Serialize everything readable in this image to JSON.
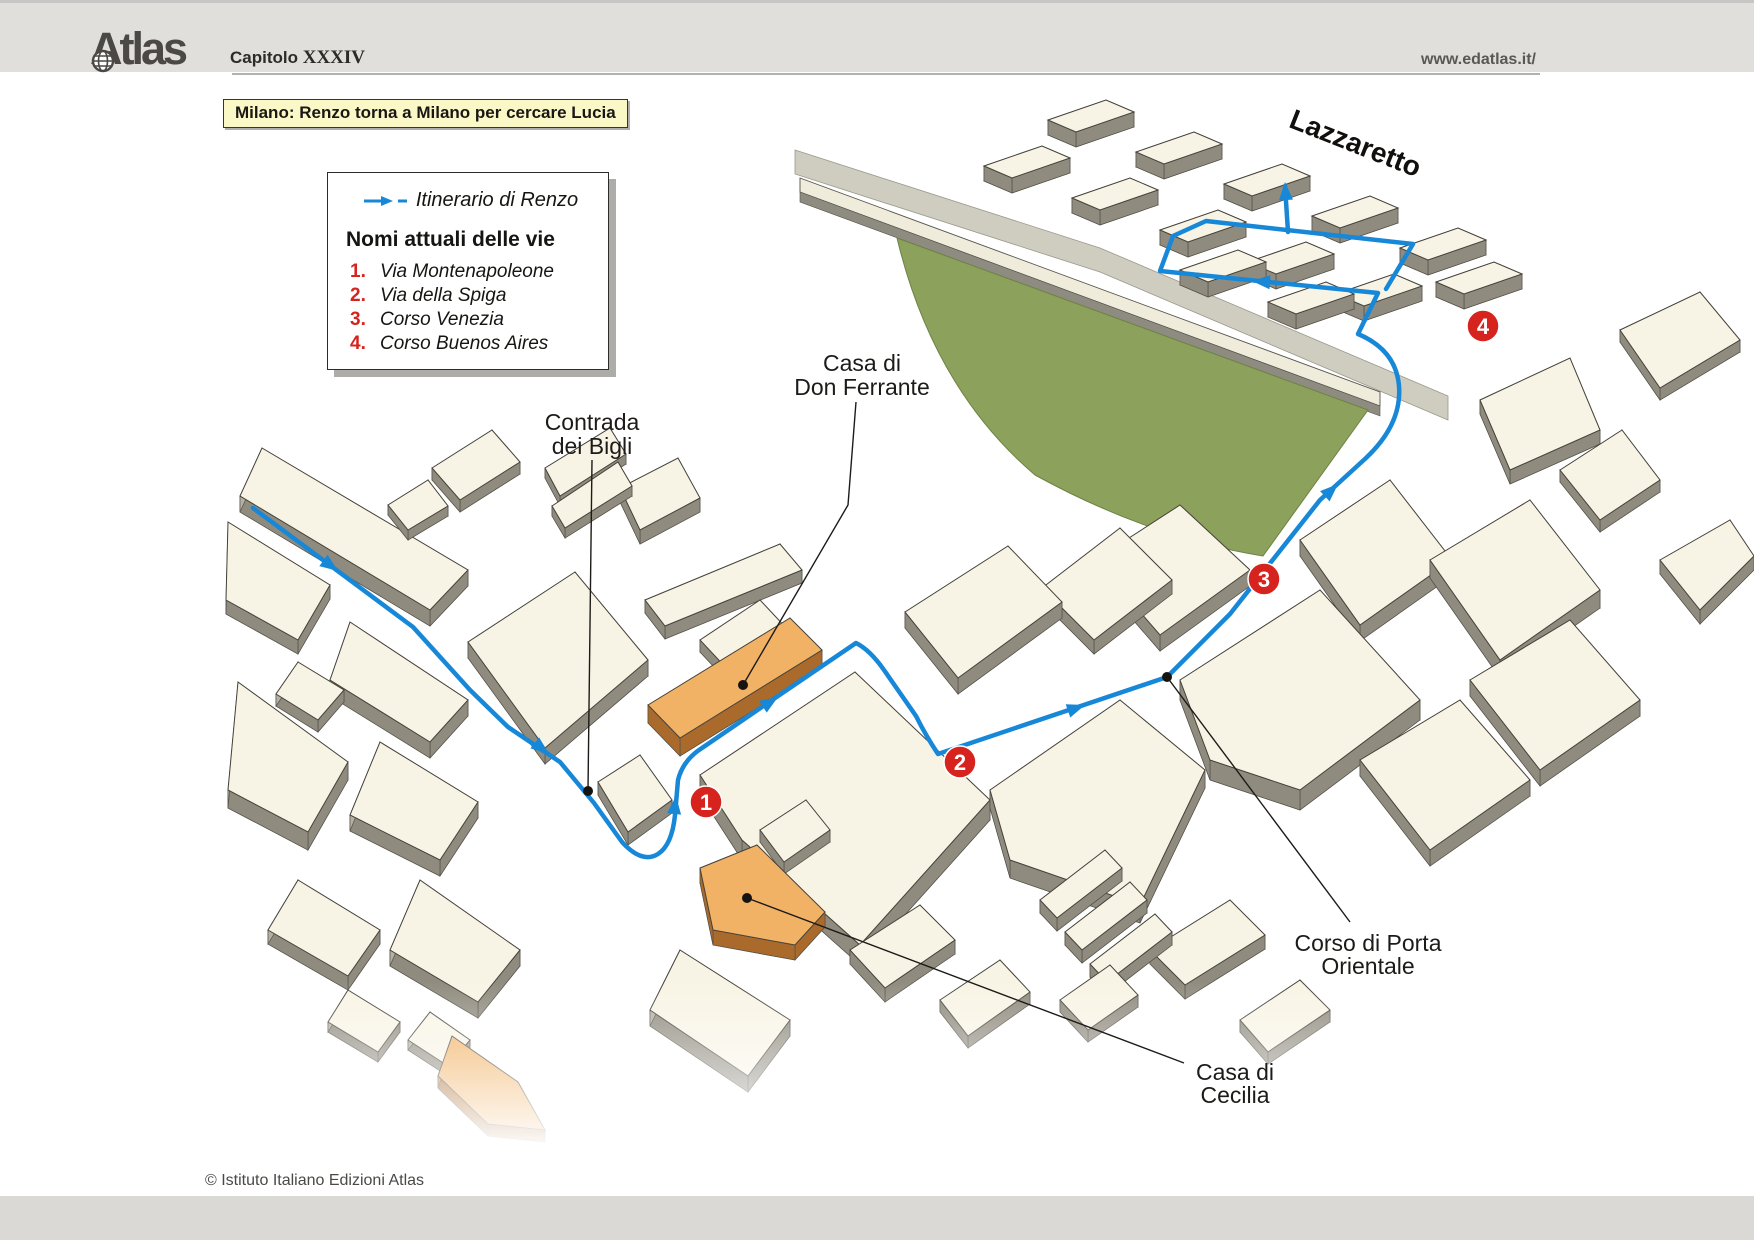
{
  "header": {
    "logo": "Atlas",
    "chapter_label": "Capitolo",
    "chapter_number": "XXXIV",
    "url": "www.edatlas.it/"
  },
  "title_box": {
    "text": "Milano: Renzo torna a Milano per cercare Lucia"
  },
  "legend": {
    "itinerary_label": "Itinerario di Renzo",
    "heading": "Nomi attuali delle vie",
    "streets": [
      {
        "num": "1.",
        "name": "Via Montenapoleone"
      },
      {
        "num": "2.",
        "name": "Via della Spiga"
      },
      {
        "num": "3.",
        "name": "Corso Venezia"
      },
      {
        "num": "4.",
        "name": "Corso Buenos Aires"
      }
    ]
  },
  "map": {
    "labels": {
      "lazzaretto": "Lazzaretto",
      "casa_don_ferrante": [
        "Casa di",
        "Don Ferrante"
      ],
      "contrada_bigli": [
        "Contrada",
        "dei Bigli"
      ],
      "corso_porta_orientale": [
        "Corso di Porta",
        "Orientale"
      ],
      "casa_cecilia": [
        "Casa di",
        "Cecilia"
      ]
    },
    "route_markers": [
      "1",
      "2",
      "3",
      "4"
    ]
  },
  "footer": {
    "copyright": "© Istituto Italiano Edizioni Atlas"
  },
  "colors": {
    "route_blue": "#1787d8",
    "marker_red": "#d6231e",
    "building_top": "#f8f4e5",
    "building_side": "#b4b0a3",
    "building_side_dark": "#8f8b7e",
    "highlight_orange": "#f2b266",
    "field_green": "#8ca15c",
    "road_gray": "#cfccc0",
    "wall_cream": "#efecdb",
    "title_bg": "#fbf8c8",
    "header_bg": "#e1dfdc"
  }
}
